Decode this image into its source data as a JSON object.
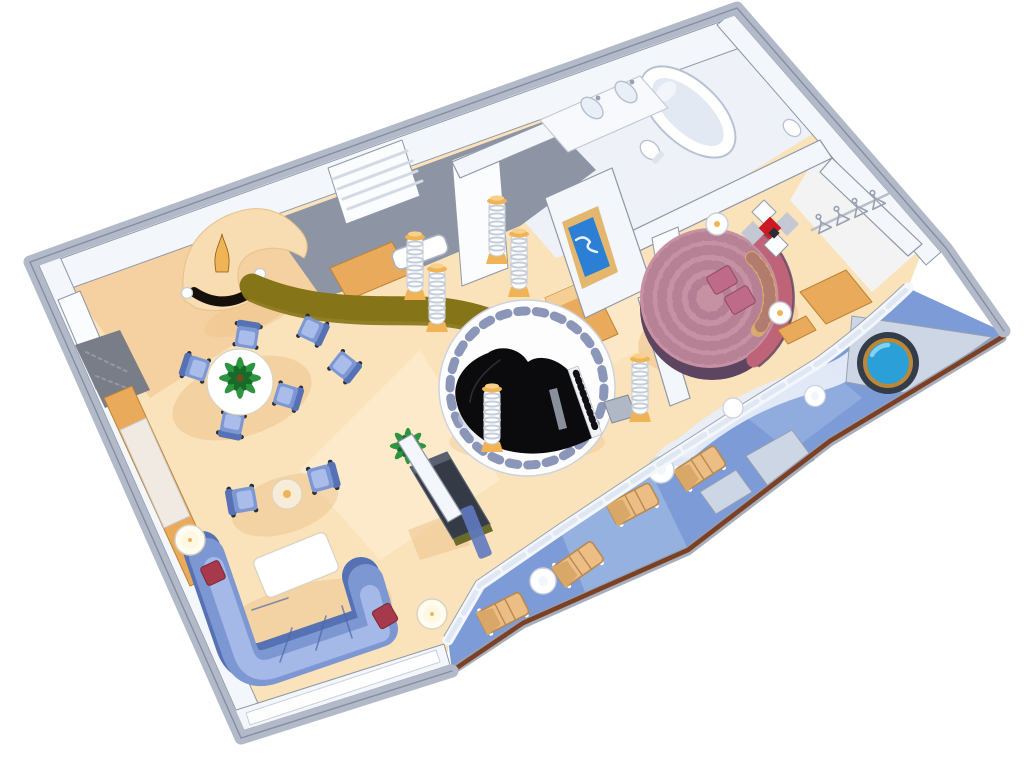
{
  "scene": {
    "type": "isometric-3d-floorplan-illustration",
    "subject": "luxury ship suite cutaway floor plan",
    "background": "#ffffff",
    "rooms": [
      "entry-foyer",
      "dining-area",
      "wet-bar",
      "living-room",
      "piano-rotunda",
      "bathroom",
      "master-bedroom",
      "walk-in-closet",
      "private-balcony"
    ],
    "inventory": {
      "living_room": [
        "sectional-sofa",
        "red-accent-pillows",
        "coffee-table",
        "armchair-pair",
        "round-side-table",
        "floor-lamps",
        "entertainment-cabinet",
        "potted-palm",
        "wall-console"
      ],
      "dining_area": [
        "round-dining-table",
        "palm-centerpiece",
        "dining-chairs (6)"
      ],
      "wet_bar": [
        "curved-bar-counter",
        "back-counter",
        "bar-sink",
        "curved-cream-console",
        "black-mantel",
        "gold-vase",
        "wall-sconces (2)",
        "louvered-wardrobe"
      ],
      "piano_rotunda": [
        "baby-grand-piano",
        "piano-bench",
        "white-circular-platform",
        "mosaic-tile-ring",
        "ribbed-columns (6)"
      ],
      "master_bedroom": [
        "round-bed",
        "curved-headboard",
        "pillows (2)",
        "nightstands (2)",
        "diamond-wall-art",
        "wall-tv",
        "stool"
      ],
      "bathroom": [
        "oval-bathtub",
        "double-sink-vanity",
        "toilet",
        "side-basin"
      ],
      "walk_in_closet": [
        "hanging-rod",
        "clothes-hangers (4)",
        "wood-drawers"
      ],
      "balcony": [
        "whirlpool-tub",
        "deck-loungers (4)",
        "round-deck-tables (3)",
        "deck-boxes (2)",
        "wood-cap-railing",
        "white-deck-path"
      ]
    }
  },
  "colors": {
    "pageBg": "#ffffff",
    "wallBand": "#b2bac9",
    "wallEdge": "#8f97a8",
    "wallFace": "#f3f6fa",
    "doorWhite": "#fbfcfe",
    "floorCream": "#fae2ba",
    "floorLight": "#fef4dd",
    "floorPeach": "#f4cf9e",
    "floorShadow": "#ecc088",
    "bathFloor": "#eef2f8",
    "barFloor": "#8d94a4",
    "barCounter": "#857418",
    "barCounterDark": "#6b5c10",
    "cabinetTan": "#eaaa5c",
    "cabinetLight": "#f6cd92",
    "cabinetEdge": "#bd8334",
    "gold": "#f0b457",
    "goldLight": "#f8d089",
    "columnWhite": "#fbfcfe",
    "columnStripe": "#c6cdd9",
    "sofaBlue": "#7d97d3",
    "sofaDark": "#5672b4",
    "sofaLight": "#aabdea",
    "cushionRed": "#a63a4c",
    "cushionEdge": "#7c2735",
    "white": "#ffffff",
    "creamTable": "#f7ecd8",
    "tableEdge": "#d8d2c0",
    "legDark": "#2c2f38",
    "palmGreen": "#2f9440",
    "palmDark": "#176b2a",
    "pianoBlack": "#0b0b0e",
    "benchGray": "#b0b7c5",
    "mosaicBlue": "#8b96b8",
    "bedRose": "#c791a4",
    "bedRoseDark": "#a06880",
    "bedSkirt": "#5d4460",
    "headboardRose": "#bf6379",
    "pillowPink": "#c06a8a",
    "goldSpot": "#e3b261",
    "artRed": "#cc1a24",
    "artGray": "#c3c8d2",
    "tvBlue": "#2b7fd4",
    "tvFrame": "#e3b86e",
    "deckBlue": "#7d9bd6",
    "deckLight": "#a9c2ea",
    "deckPale": "#e8eef8",
    "platformGray": "#ccd6e4",
    "platformEdge": "#98a0ae",
    "tubRim": "#333d49",
    "tubGold": "#bd8738",
    "waterBlue": "#2ba0d8",
    "waterLight": "#7fd2f2",
    "railBrown": "#7c4124",
    "loungerTan": "#ecbe86",
    "loungerDark": "#d9a768",
    "loungerEdge": "#b98a4e",
    "stoneGray": "#787d88",
    "glassBlue": "#dce6f2"
  }
}
